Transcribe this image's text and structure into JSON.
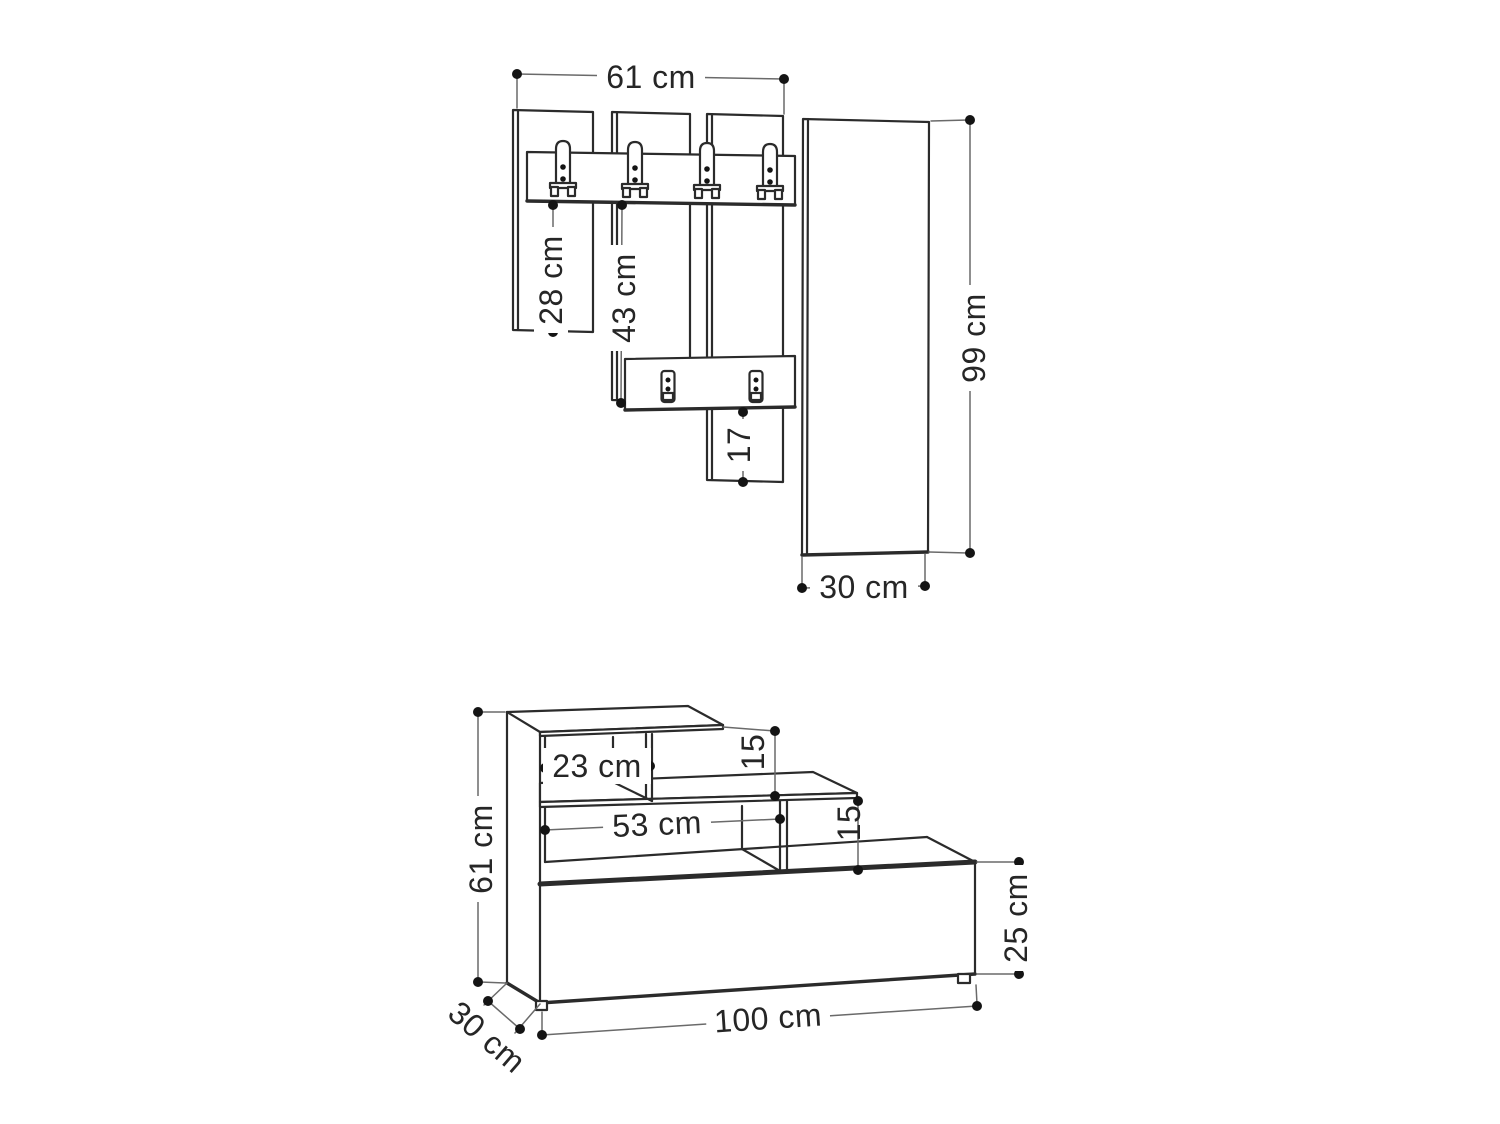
{
  "page": {
    "background": "#ffffff",
    "line_color": "#2b2b2b",
    "dimension_line_color": "#6a6a6a",
    "text_color": "#262626"
  },
  "diagram": {
    "type": "furniture-dimension-technical-drawing",
    "views": [
      {
        "name": "wall coat-rack unit with hook rail, wall plates and tall side panel",
        "hooks": 4,
        "wall_plates": 2
      },
      {
        "name": "bench / shoe cabinet unit with stepped shelves and two feet"
      }
    ],
    "labels": {
      "top_width": "61 cm",
      "panel1_height": "28 cm",
      "panel2_height": "43 cm",
      "panel3_height": "17",
      "side_panel_height": "99 cm",
      "side_panel_width": "30 cm",
      "bench_height": "61 cm",
      "top_shelf_width": "23 cm",
      "top_gap_height": "15",
      "middle_shelf_width": "53 cm",
      "middle_gap_height": "15",
      "cabinet_height": "25 cm",
      "bench_width": "100 cm",
      "bench_depth": "30 cm"
    }
  }
}
